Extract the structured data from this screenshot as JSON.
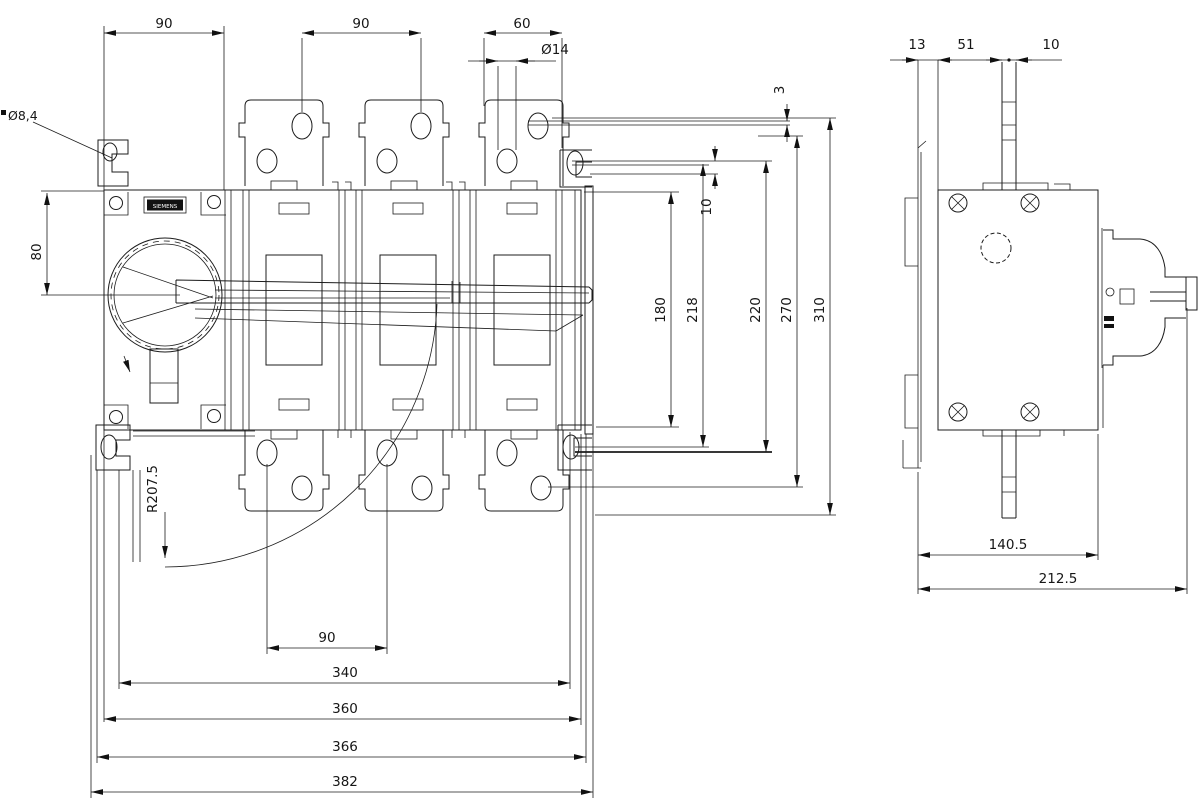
{
  "drawing": {
    "brand_label": "SIEMENS",
    "front_view": {
      "dims": {
        "top_90_left": "90",
        "top_90_mid": "90",
        "top_60": "60",
        "dia_14": "Ø14",
        "dia_8_4": "Ø8,4",
        "left_80": "80",
        "busbar_3": "3",
        "offset_10": "10",
        "right_180": "180",
        "right_218": "218",
        "right_220": "220",
        "right_270": "270",
        "right_310": "310",
        "radius_2075": "R207.5",
        "bottom_90": "90",
        "bottom_340": "340",
        "bottom_360": "360",
        "bottom_366": "366",
        "bottom_382": "382"
      }
    },
    "side_view": {
      "dims": {
        "top_13": "13",
        "top_51": "51",
        "top_10": "10",
        "bottom_140_5": "140.5",
        "bottom_212_5": "212.5"
      }
    }
  }
}
